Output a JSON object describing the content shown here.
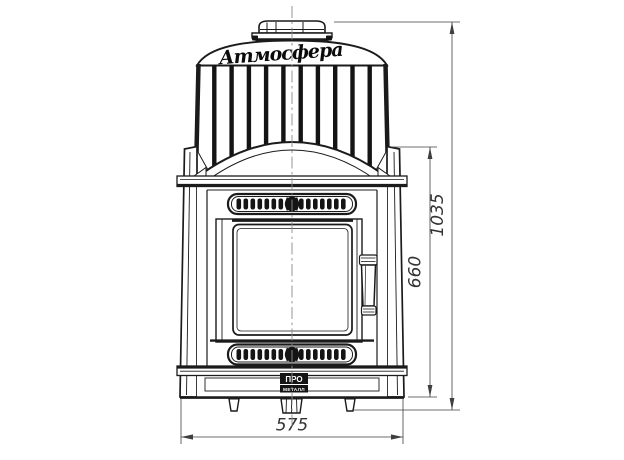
{
  "drawing": {
    "logo_script": "Атмосфера",
    "badge": {
      "top": "ПРО",
      "bottom": "МЕТАЛЛ"
    },
    "dimensions": {
      "overall_width": "575",
      "casing_height": "660",
      "overall_height": "1035"
    },
    "colors": {
      "background": "#ffffff",
      "outline": "#1b1b1b",
      "dimension_lines": "#3f3f3f",
      "centerline": "#8c8c8c",
      "fill_dark": "#141414"
    }
  }
}
